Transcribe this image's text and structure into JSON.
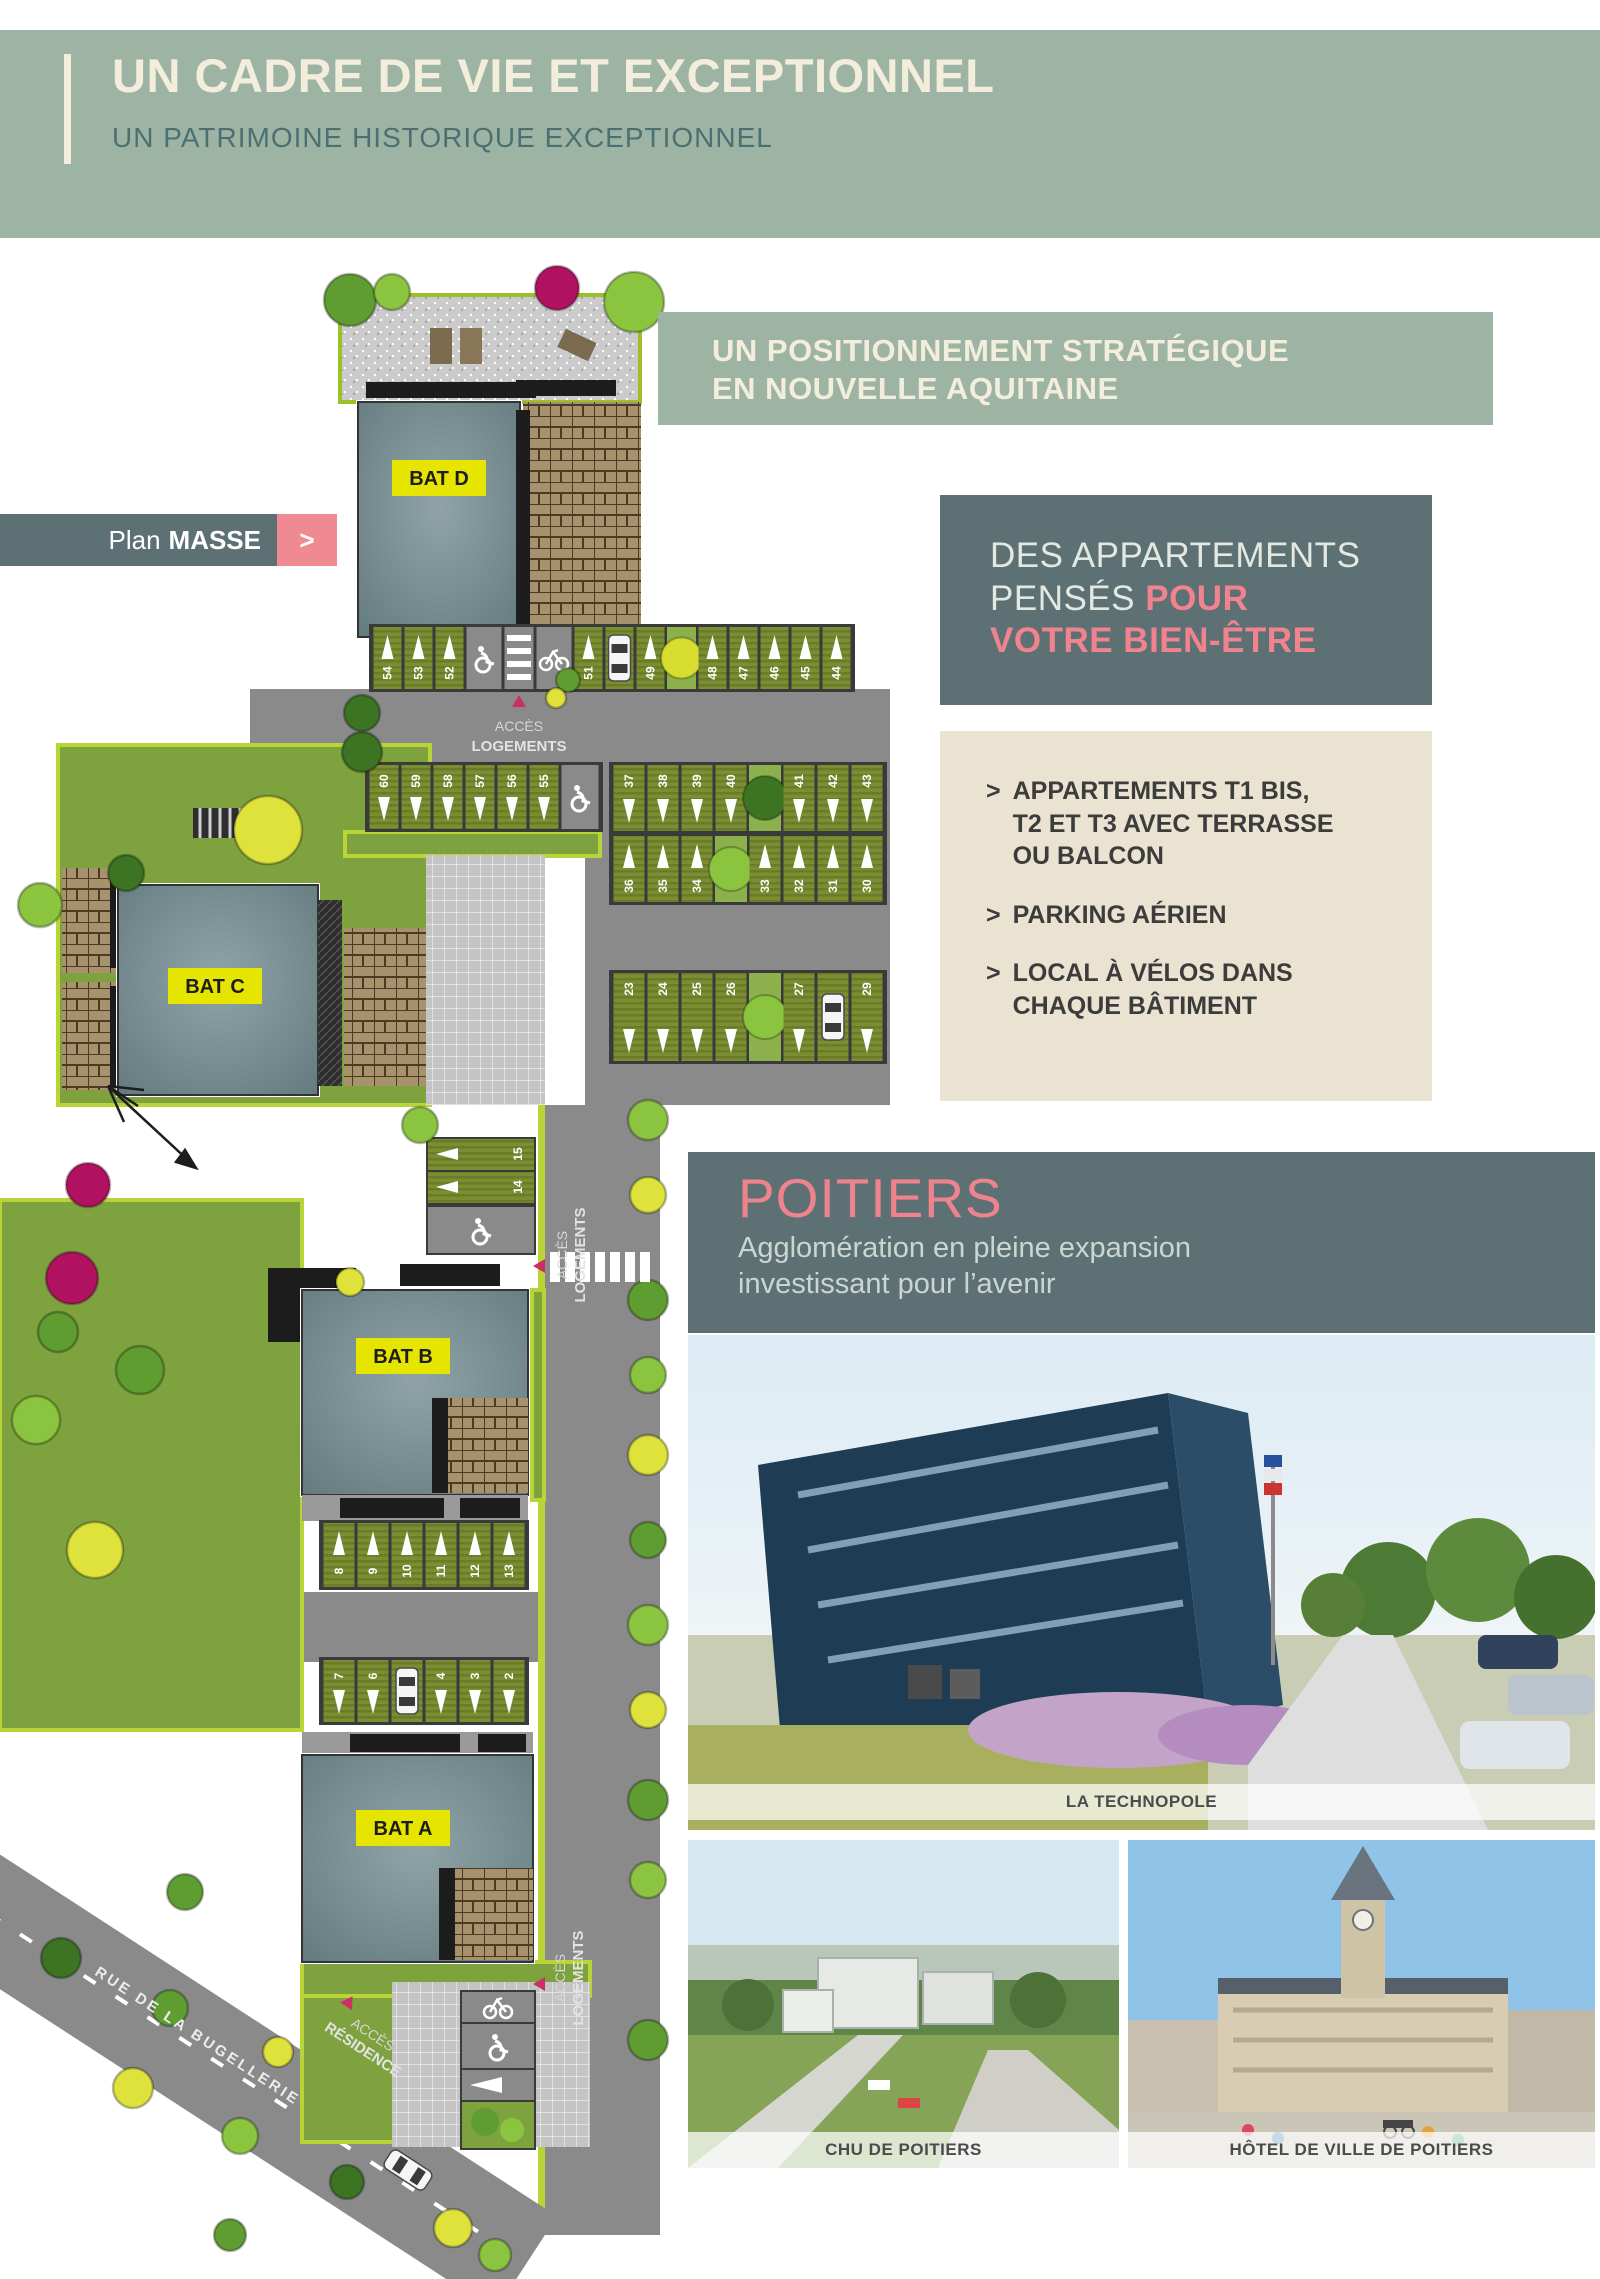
{
  "header": {
    "title": "UN CADRE DE VIE ET EXCEPTIONNEL",
    "subtitle": "UN PATRIMOINE HISTORIQUE EXCEPTIONNEL"
  },
  "plan_tag": {
    "text_normal": "Plan",
    "text_bold": "MASSE",
    "chevron": ">"
  },
  "strategic": {
    "line1": "UN POSITIONNEMENT STRATÉGIQUE",
    "line2": "EN NOUVELLE AQUITAINE"
  },
  "wellbeing": {
    "line1": "DES APPARTEMENTS",
    "line2a": "PENSÉS ",
    "line2b": "POUR",
    "line3": "VOTRE BIEN-ÊTRE"
  },
  "features": {
    "bullet": ">",
    "items": [
      [
        "APPARTEMENTS T1 BIS,",
        "T2 ET T3 AVEC TERRASSE",
        "OU BALCON"
      ],
      [
        "PARKING AÉRIEN"
      ],
      [
        "LOCAL À VÉLOS DANS",
        "CHAQUE BÂTIMENT"
      ]
    ]
  },
  "poitiers": {
    "title": "POITIERS",
    "sub1": "Agglomération en pleine expansion",
    "sub2": "investissant pour l’avenir"
  },
  "photos": {
    "technopole": "LA TECHNOPOLE",
    "chu": "CHU DE POITIERS",
    "hotel": "HÔTEL DE VILLE DE POITIERS"
  },
  "plan": {
    "buildings": {
      "a": "BAT A",
      "b": "BAT B",
      "c": "BAT C",
      "d": "BAT D"
    },
    "acces_logements_1": "ACCÈS",
    "acces_logements_2": "LOGEMENTS",
    "acces_residence_1": "ACCÈS",
    "acces_residence_2": "RÉSIDENCE",
    "street": "RUE DE LA BUGELLERIE",
    "rows": {
      "top": [
        "54",
        "53",
        "52",
        "51",
        "49",
        "48",
        "47",
        "46",
        "45",
        "44"
      ],
      "second": [
        "60",
        "59",
        "58",
        "57",
        "56",
        "55"
      ],
      "mid_upper": [
        "37",
        "38",
        "39",
        "40",
        "41",
        "42",
        "43"
      ],
      "mid_lower": [
        "36",
        "35",
        "34",
        "33",
        "32",
        "31",
        "30"
      ],
      "lower": [
        "23",
        "24",
        "25",
        "26",
        "27",
        "29"
      ],
      "batb": [
        "8",
        "9",
        "10",
        "11",
        "12",
        "13"
      ],
      "bata": [
        "7",
        "6",
        "4",
        "3",
        "2"
      ],
      "side": [
        "15",
        "14"
      ]
    }
  },
  "colors": {
    "band_green": "#9db3a4",
    "slate": "#5d7175",
    "pink": "#ef838e",
    "beige": "#eae3d2",
    "cream": "#f3eedc",
    "label_yellow": "#e6e500",
    "lawn": "#7da23e",
    "road": "#8a8a8a"
  }
}
